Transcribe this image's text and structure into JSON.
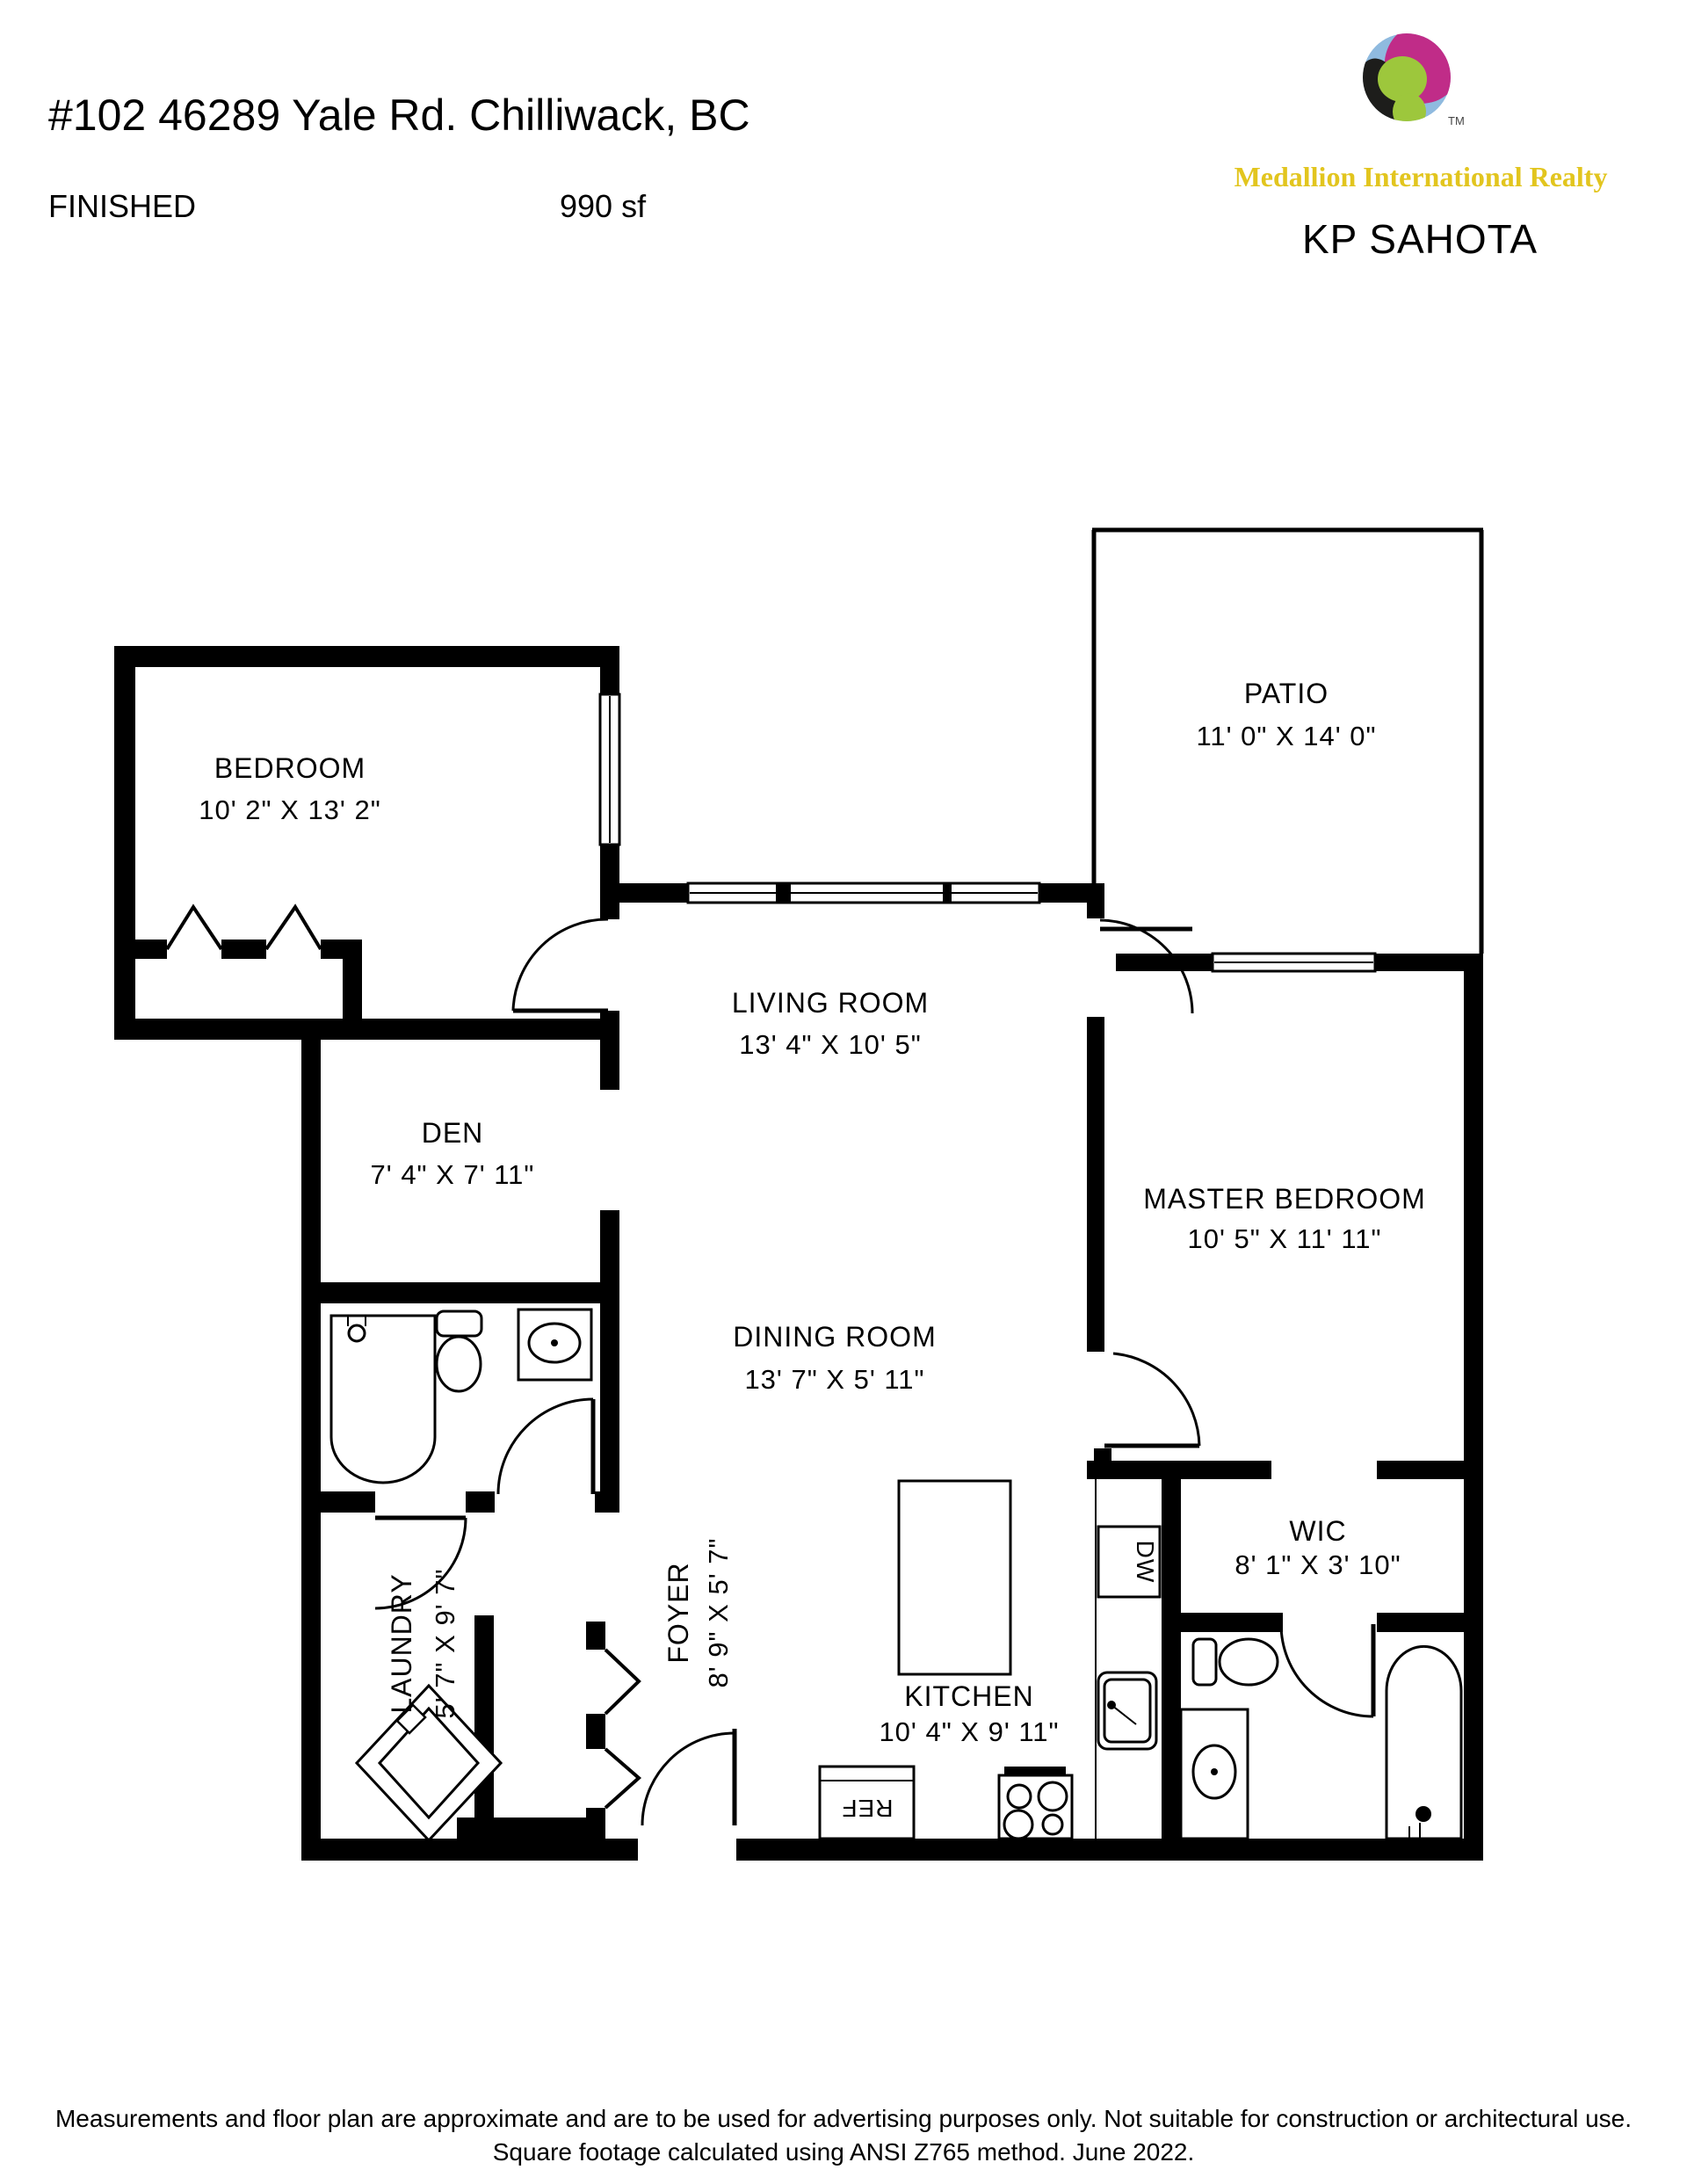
{
  "header": {
    "address": "#102 46289 Yale Rd. Chilliwack, BC",
    "status": "FINISHED",
    "area": "990 sf"
  },
  "branding": {
    "company": "Medallion International Realty",
    "agent": "KP SAHOTA",
    "trademark": "TM",
    "gold": "#E2C51E",
    "logo_colors": {
      "blue": "#8FBADF",
      "magenta": "#C02C88",
      "black": "#1D1D1B",
      "green": "#9DC73C"
    }
  },
  "rooms": {
    "bedroom": {
      "name": "BEDROOM",
      "dims": "10' 2\" X 13' 2\""
    },
    "patio": {
      "name": "PATIO",
      "dims": "11' 0\" X 14' 0\""
    },
    "living": {
      "name": "LIVING ROOM",
      "dims": "13' 4\" X 10' 5\""
    },
    "den": {
      "name": "DEN",
      "dims": "7' 4\" X 7' 11\""
    },
    "master": {
      "name": "MASTER BEDROOM",
      "dims": "10' 5\" X 11' 11\""
    },
    "dining": {
      "name": "DINING ROOM",
      "dims": "13' 7\" X 5' 11\""
    },
    "wic": {
      "name": "WIC",
      "dims": "8' 1\" X 3' 10\""
    },
    "laundry": {
      "name": "LAUNDRY",
      "dims": "5' 7\" X 9' 7\""
    },
    "foyer": {
      "name": "FOYER",
      "dims": "8' 9\" X 5' 7\""
    },
    "kitchen": {
      "name": "KITCHEN",
      "dims": "10' 4\" X 9' 11\""
    }
  },
  "appliances": {
    "dishwasher": "DW",
    "refrigerator": "REF"
  },
  "footer": {
    "line1": "Measurements and floor plan are approximate and are to be used for advertising purposes only. Not suitable for construction or architectural use.",
    "line2": "Square footage calculated using ANSI Z765 method. June 2022."
  }
}
